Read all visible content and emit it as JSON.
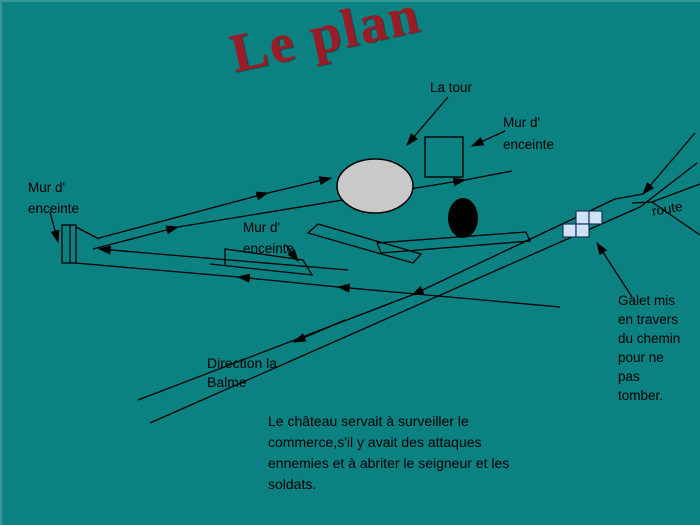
{
  "slide": {
    "title": "Le plan",
    "background_color": "#0b8181",
    "title_color": "#9b1b26"
  },
  "labels": {
    "tower": "La tour",
    "wall_right": "Mur d'\nenceinte",
    "wall_left": "Mur d'\nenceinte",
    "wall_center": "Mur d'\nenceinte",
    "route": "route",
    "galet": "Galet mis\nen travers\ndu chemin\npour ne\npas\ntomber.",
    "direction": "Direction la\nBalme",
    "caption": "Le château servait à surveiller le\ncommerce,s'il y avait des attaques\nennemies et à abriter le seigneur et les\nsoldats."
  },
  "diagram": {
    "line_color": "#000000",
    "tower_fill": "#c9c9c9",
    "keep_fill": "none",
    "well_fill": "#000000",
    "galet_fill": "#cfe3f5",
    "galet_stroke": "#17375e"
  }
}
